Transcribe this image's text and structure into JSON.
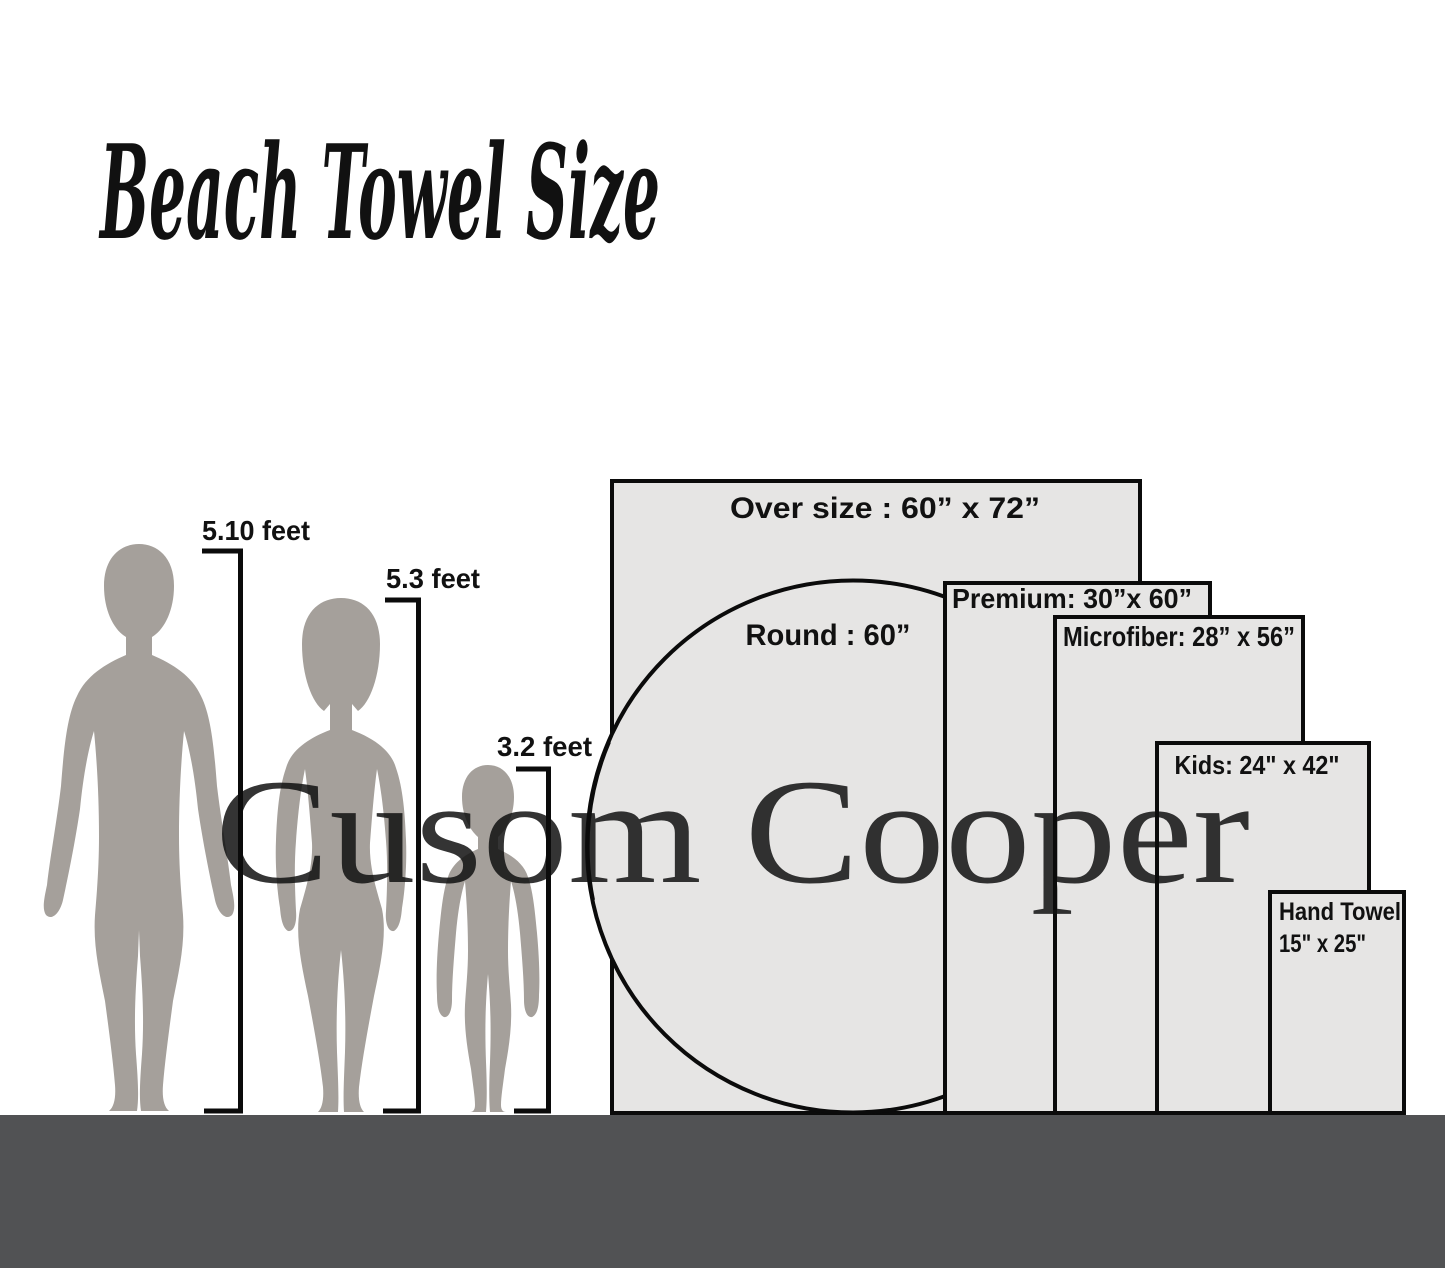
{
  "title": "Beach Towel Size",
  "watermark": "Cusom Cooper",
  "people": [
    {
      "name": "man",
      "height_label": "5.10 feet"
    },
    {
      "name": "woman",
      "height_label": "5.3 feet"
    },
    {
      "name": "child",
      "height_label": "3.2 feet"
    }
  ],
  "towels": [
    {
      "name": "oversize",
      "label": "Over size : 60” x 72”"
    },
    {
      "name": "round",
      "label": "Round : 60”"
    },
    {
      "name": "premium",
      "label": "Premium: 30”x 60”"
    },
    {
      "name": "microfiber",
      "label": "Microfiber: 28” x 56”"
    },
    {
      "name": "kids",
      "label": "Kids: 24\" x 42\""
    },
    {
      "name": "hand",
      "label_line1": "Hand Towel",
      "label_line2": "15\" x 25\""
    }
  ],
  "colors": {
    "accent": "#69C5B3",
    "silhouette": "#A5A09B",
    "towel_fill": "#E6E5E4",
    "outline": "#0B0B0B",
    "ground": "#515254",
    "watermark": "#CDCDCD",
    "label": "#111111"
  }
}
